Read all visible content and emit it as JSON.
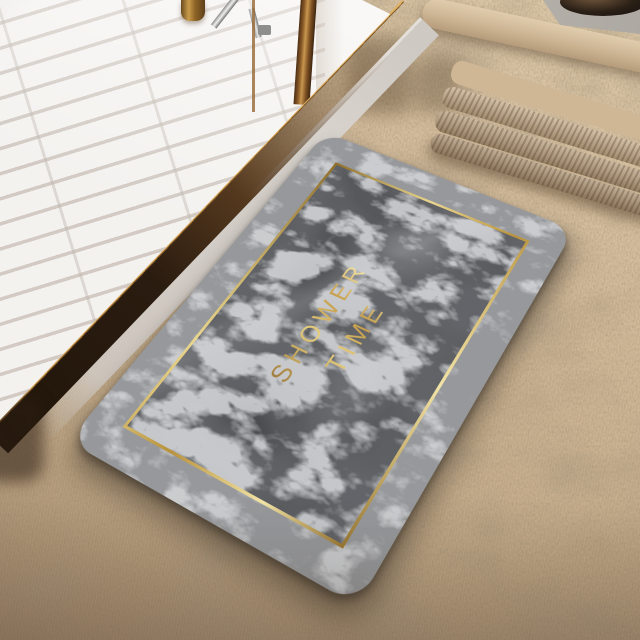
{
  "scene": {
    "objects": [
      "shower-floor",
      "door-frame-bar",
      "brass-bottle",
      "chrome-fixture",
      "door-track",
      "threshold-strip",
      "carpet-floor",
      "carpet-step",
      "towel-stack",
      "tray",
      "bath-mat"
    ]
  },
  "mat": {
    "text_line1": "SHOWER",
    "text_line2": "TIME",
    "colors": {
      "text_gold": "#d9b45e",
      "frame_gold": "#c9a84f",
      "inner_marble": "#55575a",
      "outer_marble": "#96989b"
    }
  },
  "environment": {
    "colors": {
      "carpet": "#c9b08d",
      "shower_floor_white": "#f4f2ef",
      "door_bronze": "#8a5a28",
      "threshold_gray": "#d3cdc7",
      "towels": "#bda281",
      "tray_gray": "#b5b1aa"
    }
  }
}
